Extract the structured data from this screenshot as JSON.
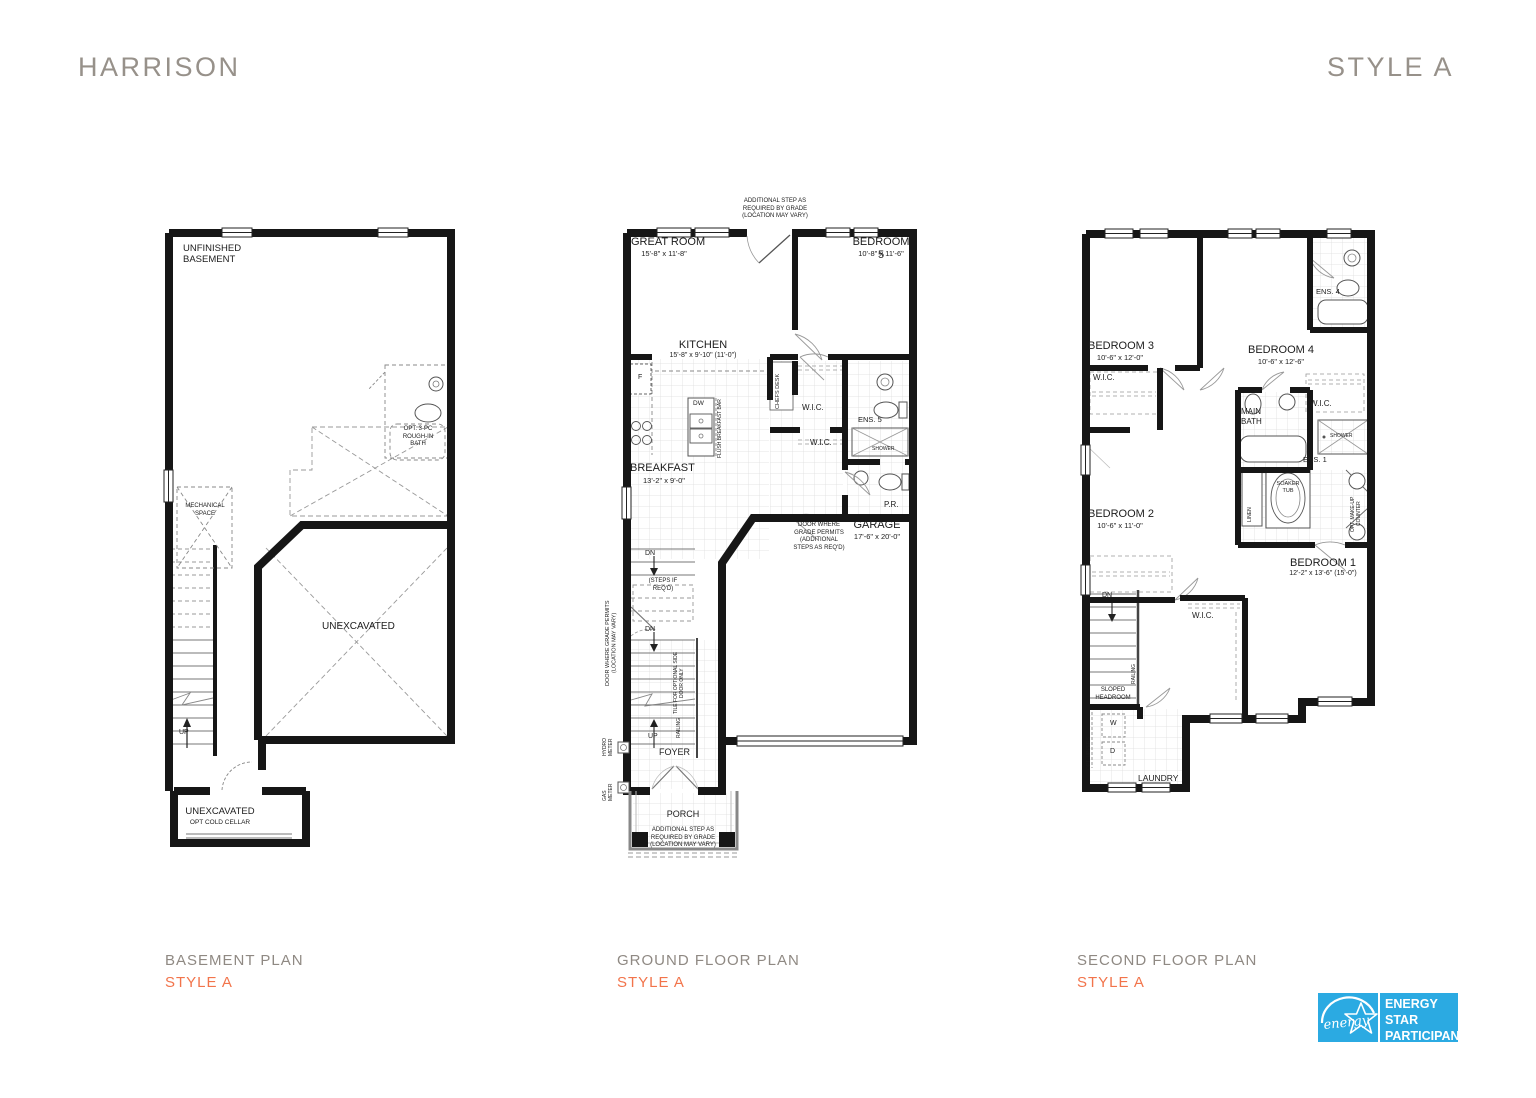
{
  "header": {
    "title": "HARRISON",
    "style": "STYLE A"
  },
  "colors": {
    "accent": "#f2744b",
    "muted": "#8f8983",
    "wall": "#161616",
    "energy_blue": "#2baae2"
  },
  "plans": {
    "basement": {
      "caption": "BASEMENT PLAN",
      "style": "STYLE A",
      "labels": {
        "unfinished": "UNFINISHED\nBASEMENT",
        "opt_bath": "OPT. 3-PC\nROUGH-IN\nBATH",
        "mechanical": "MECHANICAL\nSPACE",
        "unexcavated": "UNEXCAVATED",
        "up": "UP",
        "cold_cellar_title": "UNEXCAVATED",
        "cold_cellar_sub": "OPT COLD CELLAR"
      }
    },
    "ground": {
      "caption": "GROUND FLOOR PLAN",
      "style": "STYLE A",
      "labels": {
        "top_note": "ADDITIONAL STEP AS\nREQUIRED BY GRADE\n(LOCATION MAY VARY)",
        "great_room": "GREAT ROOM",
        "great_room_dim": "15'-8\" x 11'-8\"",
        "bedroom5": "BEDROOM 5",
        "bedroom5_dim": "10'-8\" x 11'-6\"",
        "kitchen": "KITCHEN",
        "kitchen_dim": "15'-8\" x 9'-10\" (11'-0\")",
        "chefs_desk": "CHEFS DESK",
        "fridge": "F",
        "dw": "DW",
        "flush_bar": "FLUSH BREAKFAST BAR",
        "wic_upper": "W.I.C.",
        "ens5": "ENS. 5",
        "wic_lower": "W.I.C.",
        "shower": "SHOWER",
        "breakfast": "BREAKFAST",
        "breakfast_dim": "13'-2\" x 9'-0\"",
        "dn1": "DN",
        "steps_note": "(STEPS IF\nREQ'D)",
        "dn2": "DN",
        "side_door_note": "DOOR WHERE GRADE PERMITS\n(LOCATION MAY VARY)",
        "pr": "P.R.",
        "garage_door_note": "DOOR WHERE\nGRADE PERMITS\n(ADDITIONAL\nSTEPS AS REQ'D)",
        "garage": "GARAGE",
        "garage_dim": "17'-6\" x 20'-0\"",
        "tile_note": "TILE FOR OPTIONAL SIDE\nDOOR ONLY",
        "railing": "RAILING",
        "hydro": "HYDRO\nMETER",
        "gas": "GAS\nMETER",
        "up": "UP",
        "foyer": "FOYER",
        "porch": "PORCH",
        "porch_note": "ADDITIONAL STEP AS\nREQUIRED BY GRADE\n(LOCATION MAY VARY)"
      }
    },
    "second": {
      "caption": "SECOND FLOOR PLAN",
      "style": "STYLE A",
      "labels": {
        "bedroom3": "BEDROOM 3",
        "bedroom3_dim": "10'-6\" x 12'-0\"",
        "wic_b3": "W.I.C.",
        "bedroom4": "BEDROOM 4",
        "bedroom4_dim": "10'-6\" x 12'-6\"",
        "ens4": "ENS. 4",
        "wic_b4": "W.I.C.",
        "main_bath": "MAIN\nBATH",
        "shower": "SHOWER",
        "bedroom2": "BEDROOM 2",
        "bedroom2_dim": "10'-6\" x 11'-0\"",
        "linen": "LINEN",
        "soaker_tub": "SOAKER\nTUB",
        "ens1": "ENS. 1",
        "makeup": "OPT. MAKE-UP\nCOUNTER",
        "bedroom1": "BEDROOM 1",
        "bedroom1_dim": "12'-2\" x 13'-6\" (15'-0\")",
        "dn": "DN",
        "wic_b1": "W.I.C.",
        "railing": "RAILING",
        "sloped": "SLOPED\nHEADROOM",
        "washer": "W",
        "dryer": "D",
        "opt_uppers": "OPT. UPPERS",
        "laundry": "LAUNDRY"
      }
    }
  },
  "energy_star": {
    "script": "energy",
    "text": "ENERGY\nSTAR\nPARTICIPANT"
  }
}
